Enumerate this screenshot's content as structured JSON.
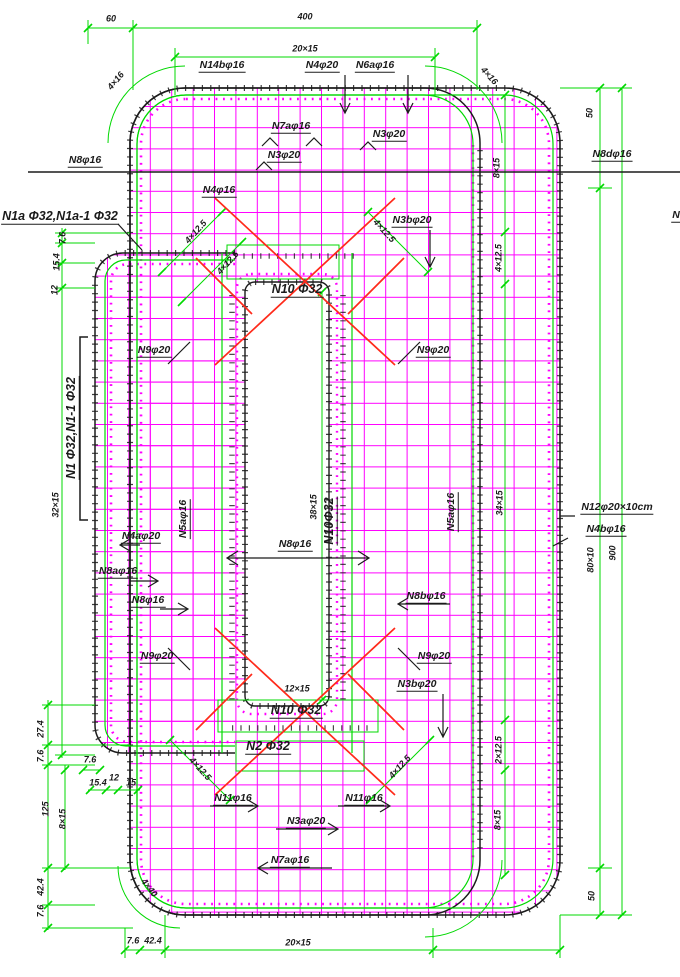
{
  "colors": {
    "grid": "#FF00FF",
    "dimension": "#00D800",
    "outline": "#1B1B1B",
    "brace": "#FF2A1A",
    "background": "#FFFFFF"
  },
  "t": {
    "n14b": "N14bφ16",
    "n4": "N4φ20",
    "n6a": "N6aφ16",
    "n7a": "N7aφ16",
    "n3": "N3φ20",
    "n8": "N8φ16",
    "n8d": "N8dφ16",
    "n1a": "N1a Φ32,N1a-1 Φ32",
    "n4s": "N4φ16",
    "n3b": "N3bφ20",
    "n10": "N10 Φ32",
    "n10v": "N10Φ32",
    "n9": "N9φ20",
    "n5a": "N5aφ16",
    "n4a": "N4aφ20",
    "n8a": "N8aφ16",
    "n8b": "N8bφ16",
    "n12": "N12φ20×10cm",
    "n4b": "N4bφ16",
    "n2": "N2 Φ32",
    "n11": "N11φ16",
    "n3a": "N3aφ20",
    "n1v": "N1 Φ32,N1-1 Φ32",
    "nfrag": "N",
    "d60": "60",
    "d400": "400",
    "d20x15": "20×15",
    "d4x16": "4×16",
    "d50": "50",
    "d8x15": "8×15",
    "d4x12": "4×12.5",
    "d2x12": "2×12.5",
    "d34x15": "34×15",
    "d38x15": "38×15",
    "d32x15": "32×15",
    "d12x15": "12×15",
    "d80x10": "80×10",
    "d900": "900",
    "d12": "12",
    "d15": "15",
    "d7_6": "7.6",
    "d15_4": "15.4",
    "d27_4": "27.4",
    "d125": "125",
    "d42_4": "42.4",
    "d4x40": "4×40"
  }
}
